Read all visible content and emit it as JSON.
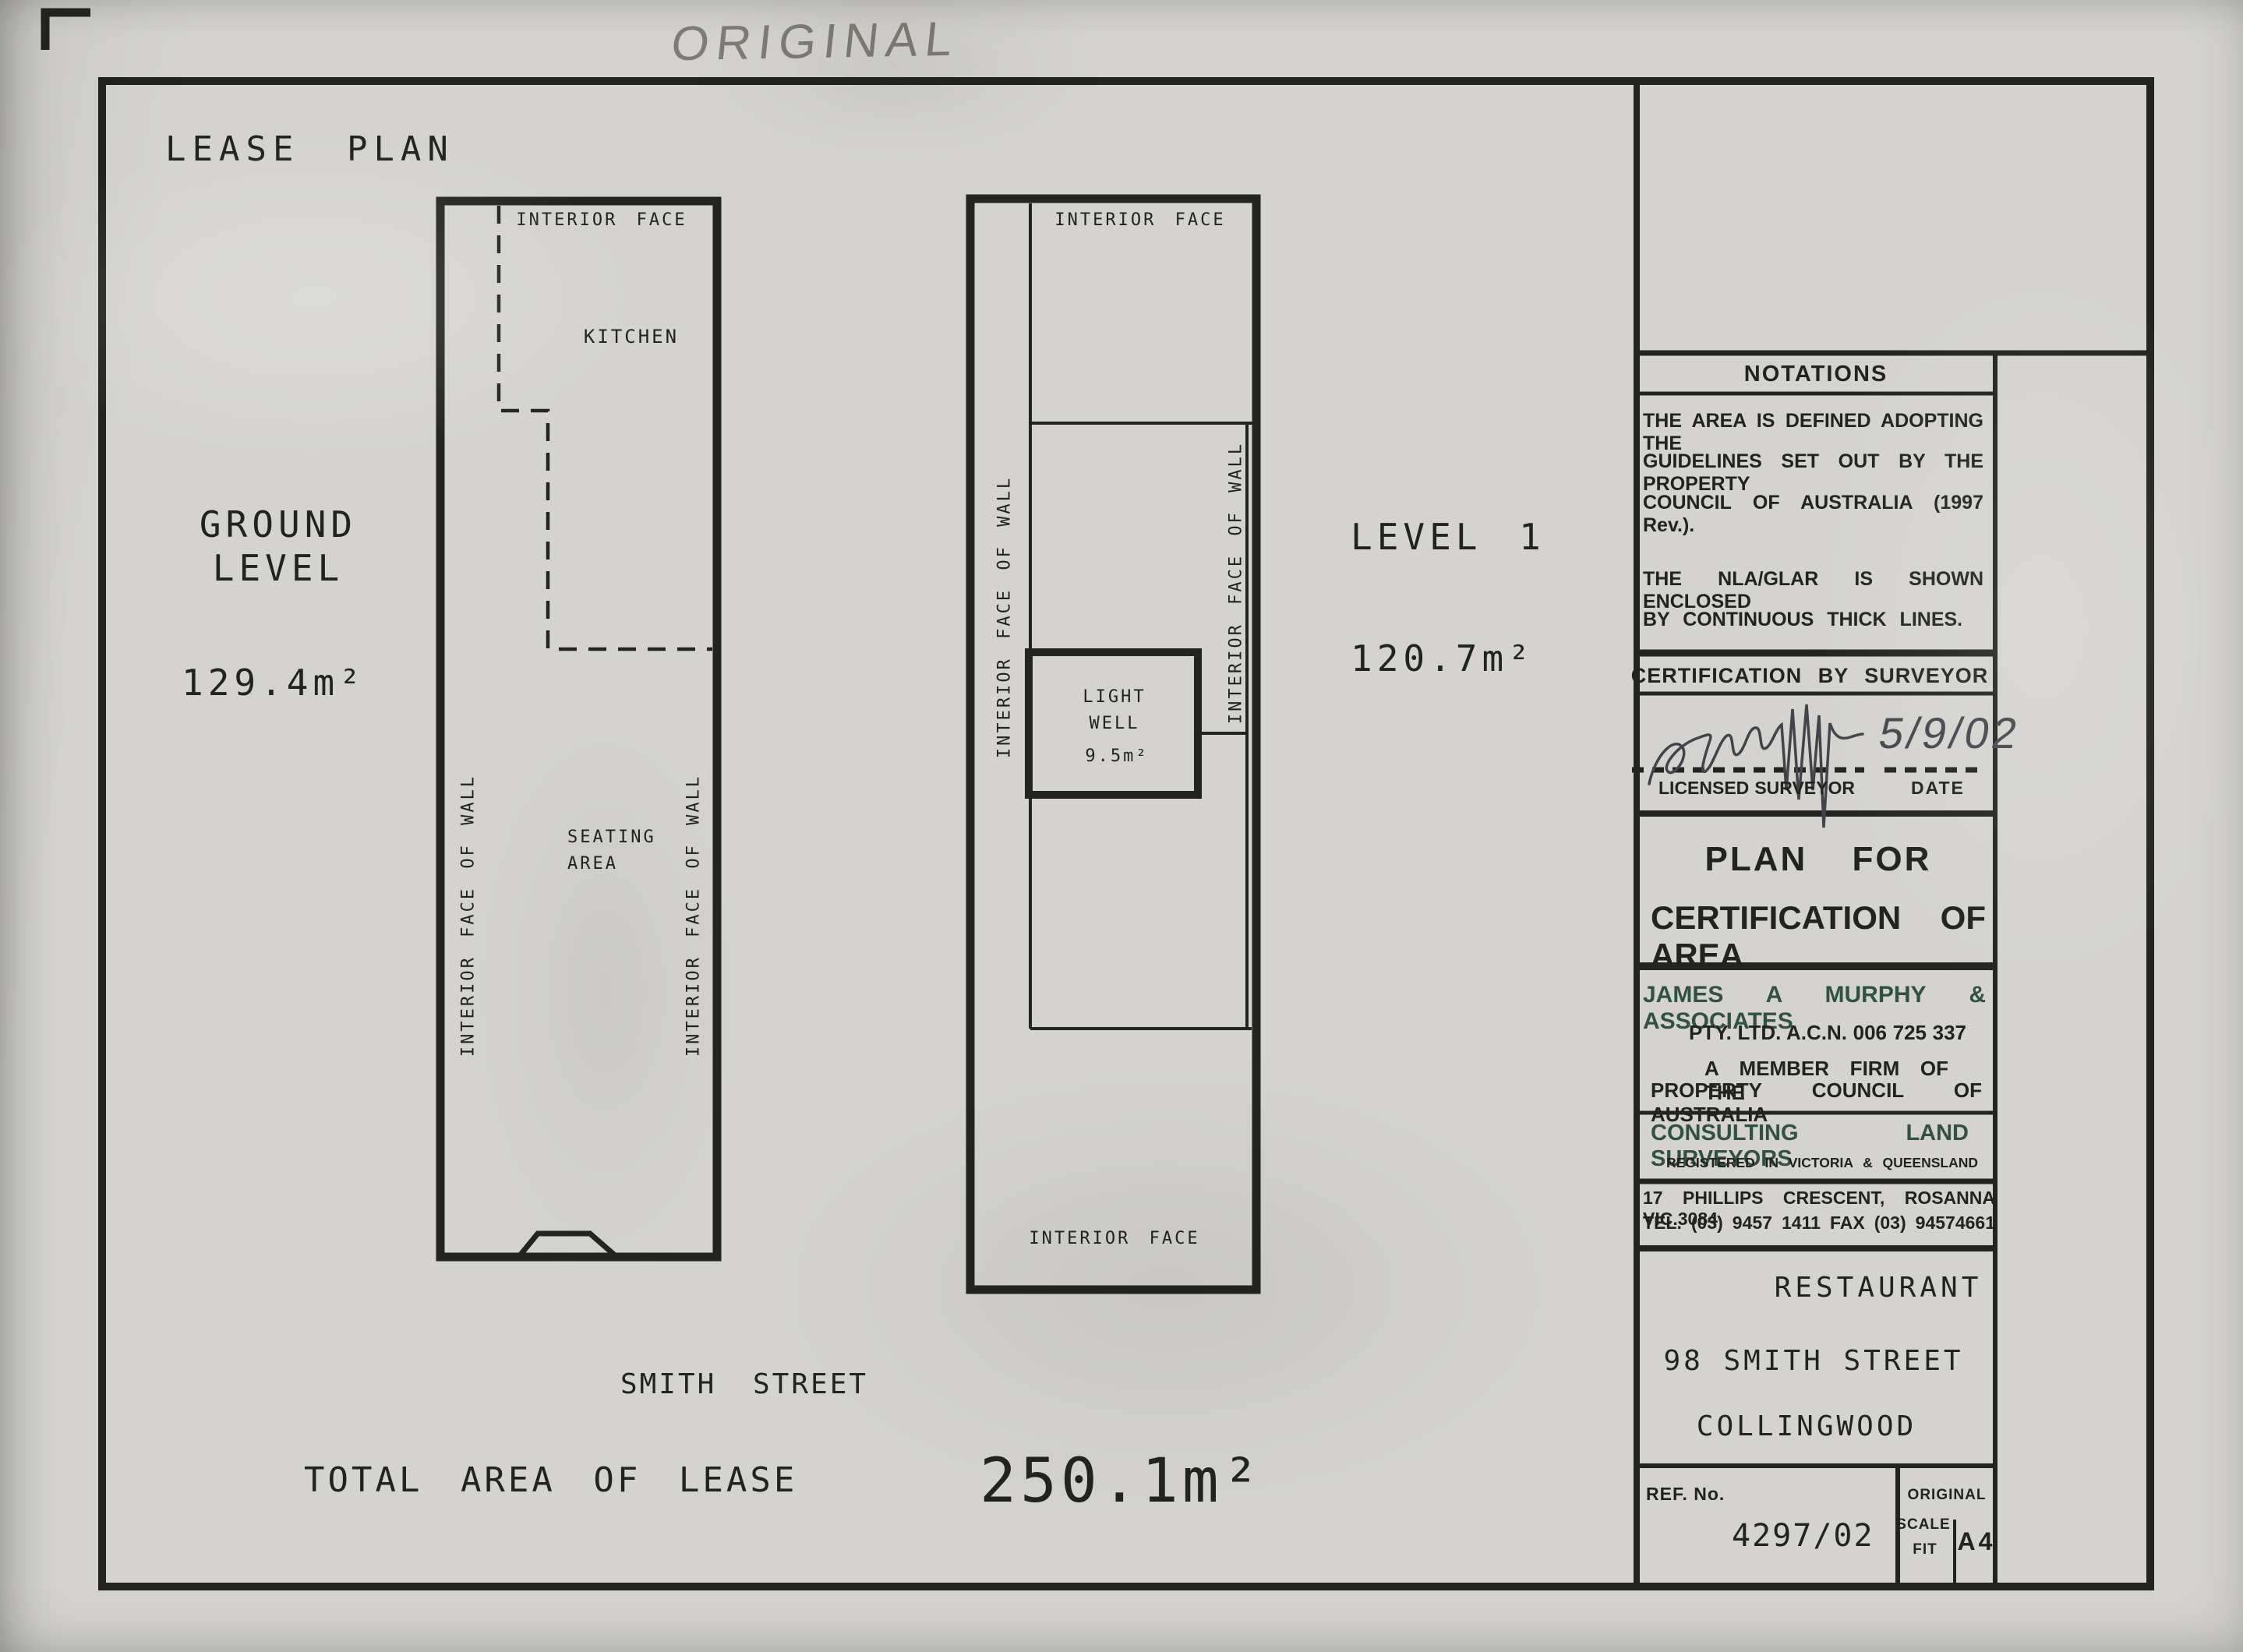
{
  "annotations": {
    "handwritten": "ORIGINAL"
  },
  "drawing": {
    "title": "LEASE PLAN",
    "street_label": "SMITH STREET",
    "total_label": "TOTAL AREA OF LEASE",
    "total_value": "250.1m²",
    "ground": {
      "name_line1": "GROUND",
      "name_line2": "LEVEL",
      "area": "129.4m²",
      "top_face": "INTERIOR FACE",
      "kitchen": "KITCHEN",
      "seating_line1": "SEATING",
      "seating_line2": "AREA",
      "wall_label": "INTERIOR FACE OF WALL"
    },
    "level1": {
      "name": "LEVEL 1",
      "area": "120.7m²",
      "top_face": "INTERIOR FACE",
      "bottom_face": "INTERIOR FACE",
      "wall_label": "INTERIOR FACE OF WALL",
      "light_well_line1": "LIGHT",
      "light_well_line2": "WELL",
      "light_well_area": "9.5m²"
    }
  },
  "panel": {
    "notations": {
      "title": "NOTATIONS",
      "line1": "THE AREA IS DEFINED ADOPTING THE",
      "line2": "GUIDELINES SET OUT BY THE PROPERTY",
      "line3": "COUNCIL OF AUSTRALIA (1997 Rev.).",
      "line4": "THE NLA/GLAR IS SHOWN ENCLOSED",
      "line5": "BY CONTINUOUS THICK LINES."
    },
    "certification": {
      "title": "CERTIFICATION BY SURVEYOR",
      "signed_date": "5/9/02",
      "left_label": "LICENSED SURVEYOR",
      "right_label": "DATE"
    },
    "plan_for": {
      "line1": "PLAN FOR",
      "line2": "CERTIFICATION OF AREA"
    },
    "firm": {
      "name": "JAMES A MURPHY & ASSOCIATES",
      "pty_acn": "PTY. LTD. A.C.N. 006 725 337",
      "member_line1": "A MEMBER FIRM OF THE",
      "member_line2": "PROPERTY COUNCIL OF AUSTRALIA",
      "consulting": "CONSULTING LAND SURVEYORS",
      "registered": "REGISTERED IN VICTORIA & QUEENSLAND",
      "address": "17 PHILLIPS CRESCENT, ROSANNA VIC.3084",
      "phone": "TEL. (03) 9457 1411 FAX (03) 94574661"
    },
    "project": {
      "type": "RESTAURANT",
      "street": "98 SMITH STREET",
      "suburb": "COLLINGWOOD"
    },
    "ref": {
      "label": "REF. No.",
      "number": "4297/02",
      "original": "ORIGINAL",
      "scale_line1": "SCALE",
      "scale_line2": "FIT",
      "paper_size": "A4"
    }
  }
}
